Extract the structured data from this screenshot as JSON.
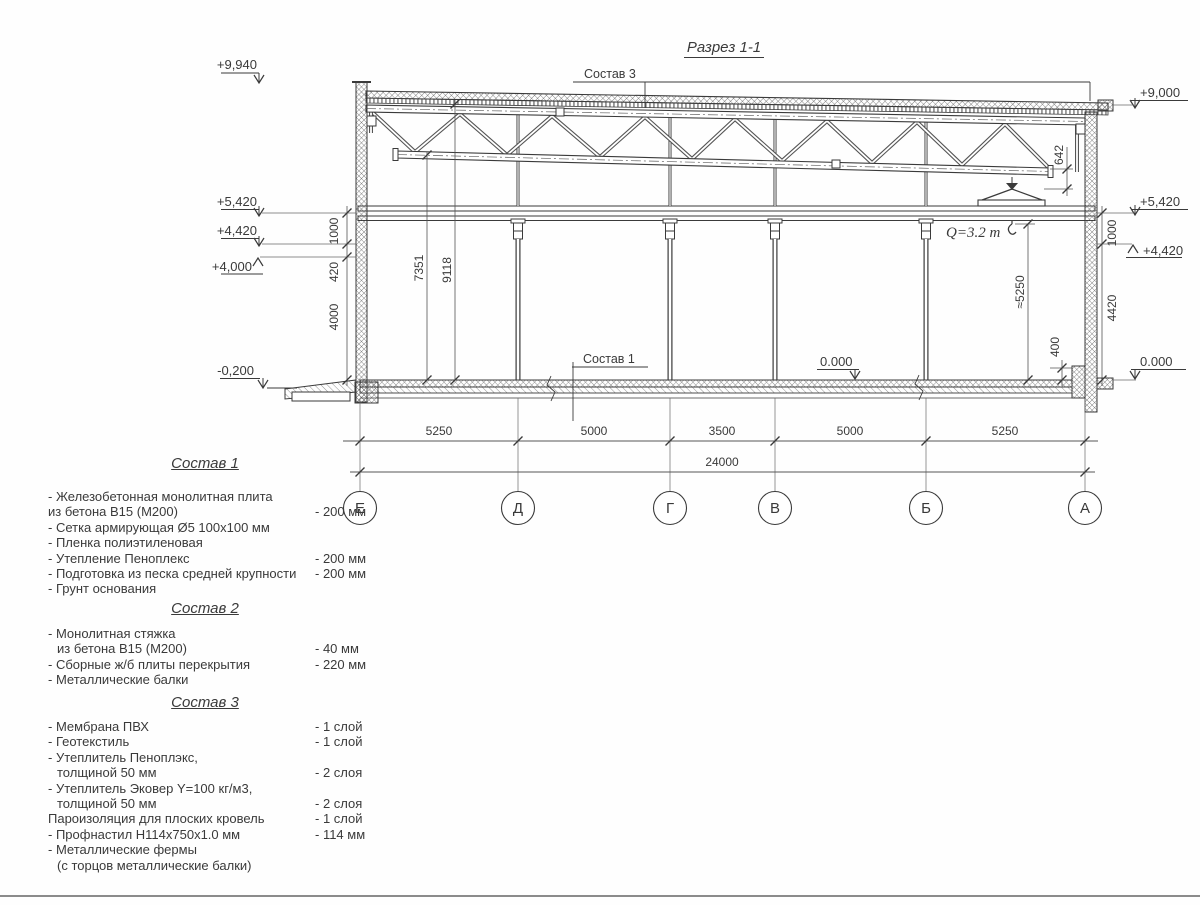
{
  "page": {
    "title": "Разрез 1-1"
  },
  "section": {
    "callouts": {
      "sostav3": "Состав 3",
      "sostav1": "Состав 1",
      "crane": "Q=3.2 т"
    },
    "levels": {
      "left": [
        "+9,940",
        "+5,420",
        "+4,420",
        "+4,000",
        "-0,200"
      ],
      "right": [
        "+9,000",
        "+5,420",
        "+4,420",
        "0.000"
      ],
      "mid": "0.000"
    },
    "dims": {
      "v_left": [
        "1000",
        "420",
        "4000"
      ],
      "v_interior": [
        "7351",
        "9118"
      ],
      "v_right": [
        "1000",
        "4420"
      ],
      "v_642": "642",
      "v_hook": "≈5250",
      "v_400": "400",
      "spans": [
        "5250",
        "5000",
        "3500",
        "5000",
        "5250"
      ],
      "total": "24000"
    },
    "axes": [
      "Е",
      "Д",
      "Г",
      "В",
      "Б",
      "А"
    ]
  },
  "compositions": [
    {
      "heading": "Состав 1",
      "items": [
        {
          "text": "- Железобетонная  монолитная плита",
          "value": ""
        },
        {
          "text": "из бетона  В15 (М200)",
          "value": "- 200 мм"
        },
        {
          "text": "- Сетка армирующая Ø5 100х100 мм",
          "value": ""
        },
        {
          "text": "- Пленка полиэтиленовая",
          "value": ""
        },
        {
          "text": "- Утепление Пеноплекс",
          "value": "- 200 мм"
        },
        {
          "text": "- Подготовка из песка средней  крупности",
          "value": "- 200 мм"
        },
        {
          "text": "- Грунт основания",
          "value": ""
        }
      ]
    },
    {
      "heading": "Состав 2",
      "items": [
        {
          "text": "- Монолитная стяжка",
          "value": ""
        },
        {
          "text": "из бетона В15 (М200)",
          "value": "- 40 мм"
        },
        {
          "text": "- Сборные ж/б плиты перекрытия",
          "value": "- 220 мм"
        },
        {
          "text": "- Металлические балки",
          "value": ""
        }
      ]
    },
    {
      "heading": "Состав 3",
      "items": [
        {
          "text": "- Мембрана ПВХ",
          "value": "- 1 слой"
        },
        {
          "text": "- Геотекстиль",
          "value": "- 1 слой"
        },
        {
          "text": "- Утеплитель Пеноплэкс,",
          "value": ""
        },
        {
          "text": "толщиной 50 мм",
          "value": "- 2 слоя"
        },
        {
          "text": "- Утеплитель Эковер Y=100 кг/м3,",
          "value": ""
        },
        {
          "text": "толщиной 50 мм",
          "value": "- 2 слоя"
        },
        {
          "text": "Пароизоляция для плоских кровель",
          "value": "- 1 слой"
        },
        {
          "text": "- Профнастил Н114х750х1.0 мм",
          "value": "- 114 мм"
        },
        {
          "text": "- Металлические фермы",
          "value": ""
        },
        {
          "text": "(с торцов металлические балки)",
          "value": ""
        }
      ]
    }
  ]
}
